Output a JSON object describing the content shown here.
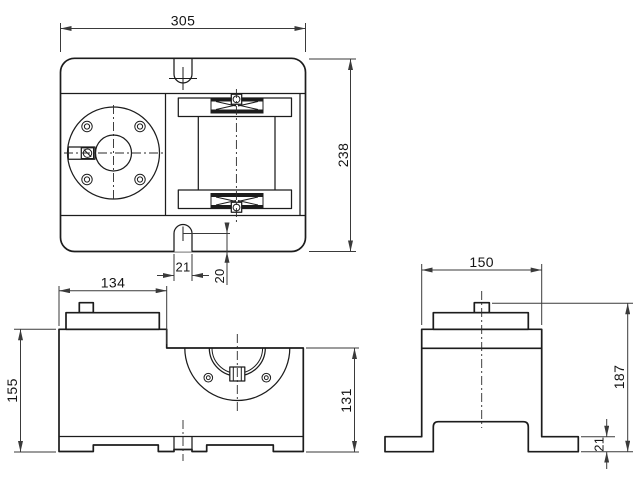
{
  "drawing": {
    "kind": "three-view orthographic technical drawing",
    "background": "#ffffff",
    "line_color": "#1c1c1c",
    "dimension_line_color": "#3a3a3a"
  },
  "dims": {
    "top_width": "305",
    "top_depth": "238",
    "slot_width": "21",
    "slot_offset": "20",
    "front_block_width": "134",
    "front_total_height": "155",
    "front_right_height": "131",
    "side_top_width": "150",
    "side_total_height": "187",
    "side_foot_height": "21"
  }
}
